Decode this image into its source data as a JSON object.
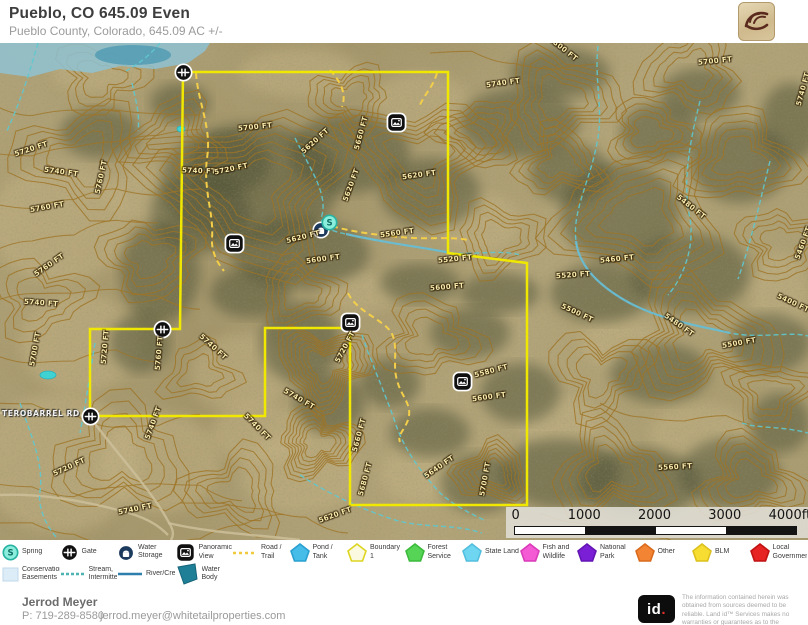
{
  "header": {
    "title": "Pueblo, CO 645.09 Even",
    "subtitle": "Pueblo County, Colorado, 645.09 AC +/-"
  },
  "footer": {
    "agent_name": "Jerrod Meyer",
    "phone": "P: 719-289-8580",
    "email": "jerrod.meyer@whitetailproperties.com",
    "brand_id": "id",
    "brand_dot": ".",
    "disclaimer": "The information contained herein was obtained from sources deemed to be reliable. Land id™ Services makes no warranties or guarantees as to the completeness or accuracy thereof."
  },
  "scale_bar": {
    "labels": [
      "0",
      "1000",
      "2000",
      "3000",
      "4000ft"
    ],
    "segment_colors": [
      "#ffffff",
      "#141414",
      "#ffffff",
      "#141414"
    ]
  },
  "legend": {
    "row1": [
      {
        "label": "Spring",
        "swatch": {
          "kind": "spring"
        }
      },
      {
        "label": "Gate",
        "swatch": {
          "kind": "gate"
        }
      },
      {
        "label": "Water Storage Tank",
        "swatch": {
          "kind": "tank"
        }
      },
      {
        "label": "Panoramic View",
        "swatch": {
          "kind": "pano"
        }
      },
      {
        "label": "Road / Trail",
        "swatch": {
          "kind": "line",
          "color": "#f0c93d",
          "dash": "3,3"
        }
      },
      {
        "label": "Pond / Tank",
        "swatch": {
          "kind": "poly",
          "fill": "#45bde8",
          "stroke": "#2a9fd0"
        }
      },
      {
        "label": "Boundary 1",
        "swatch": {
          "kind": "poly",
          "fill": "#fbf9df",
          "stroke": "#ddd520"
        }
      },
      {
        "label": "Forest Service",
        "swatch": {
          "kind": "poly",
          "fill": "#55d455",
          "stroke": "#3cba3c"
        }
      },
      {
        "label": "State Land",
        "swatch": {
          "kind": "poly",
          "fill": "#6fd6f2",
          "stroke": "#52bedd"
        }
      },
      {
        "label": "Fish and Wildlife",
        "swatch": {
          "kind": "poly",
          "fill": "#f55ad5",
          "stroke": "#d93bb8"
        }
      },
      {
        "label": "National Park",
        "swatch": {
          "kind": "poly",
          "fill": "#7a1fd6",
          "stroke": "#6315b3"
        }
      },
      {
        "label": "Other",
        "swatch": {
          "kind": "poly",
          "fill": "#f28433",
          "stroke": "#d96a1d"
        }
      },
      {
        "label": "BLM",
        "swatch": {
          "kind": "poly",
          "fill": "#f7dc32",
          "stroke": "#dcc01c"
        }
      },
      {
        "label": "Local Government",
        "swatch": {
          "kind": "poly",
          "fill": "#e62222",
          "stroke": "#c01212"
        }
      }
    ],
    "row2": [
      {
        "label": "Conservation Easements",
        "swatch": {
          "kind": "rect",
          "fill": "#dcedf8",
          "stroke": "#c2d8ea"
        }
      },
      {
        "label": "Stream, Intermittent",
        "swatch": {
          "kind": "line",
          "color": "#4fb3b3",
          "dash": "3,2"
        }
      },
      {
        "label": "River/Creek",
        "swatch": {
          "kind": "line",
          "color": "#2e7fae",
          "dash": ""
        }
      },
      {
        "label": "Water Body",
        "swatch": {
          "kind": "polybig",
          "fill": "#1f7f96",
          "stroke": "#16657a"
        }
      }
    ]
  },
  "map": {
    "road_label": {
      "text": "TEROBARREL RD",
      "x": 2,
      "y": 366
    },
    "colors": {
      "contour": "#9d7426",
      "boundary": "#f0e800",
      "trail": "#f2ce4a",
      "stream": "#5fc8cf",
      "river": "#68bcd4",
      "dirt_road": "#cdbf9a",
      "water_body": "#8fc2d2",
      "pond": "#3fd2d2"
    },
    "boundary_points": "183,29 448,29 448,210 527,220 527,462 350,462 350,285 265,285 265,373 90,373 90,286 180,286",
    "water_body_points": "0,0 210,0 205,8 188,20 155,26 120,23 92,30 60,26 30,34 0,30",
    "water_dark_patch": {
      "cx": 133,
      "cy": 12,
      "rx": 38,
      "ry": 10
    },
    "ponds": [
      {
        "cx": 181,
        "cy": 86,
        "rx": 4,
        "ry": 3
      },
      {
        "cx": 48,
        "cy": 332,
        "rx": 8,
        "ry": 4
      }
    ],
    "trails": [
      "M196,30 C198,60 212,85 207,115 C203,148 214,170 212,195 C211,210 219,222 224,228",
      "M330,27 C340,38 347,50 342,64",
      "M437,30 C433,44 424,52 420,62",
      "M332,183 C352,189 378,192 400,194 C428,197 448,193 468,197",
      "M348,250 C356,268 382,276 391,289 C399,302 392,322 397,337 C401,354 413,361 408,377 C404,388 397,392 400,399"
    ],
    "streams": [
      "M38,0 C30,28 22,55 6,90",
      "M160,0 C150,12 140,20 126,28",
      "M132,40 C136,58 140,72 138,88",
      "M295,95 C308,122 328,150 322,172 C319,183 330,188 346,191 C380,199 420,204 446,209 C470,213 500,206 520,212",
      "M598,3 C594,38 604,68 597,100 C590,138 572,168 576,198 C579,224 600,243 626,258 C660,277 700,283 730,290 C762,296 790,288 808,293",
      "M700,58 C690,98 682,138 690,176 C695,206 682,236 668,252",
      "M770,118 C760,158 752,196 738,236",
      "M362,292 C372,322 386,352 396,382 C406,410 422,430 440,450 C456,464 470,470 486,478",
      "M300,432 C330,452 362,466 392,476 C422,486 452,480 482,490",
      "M20,360 C30,390 44,420 40,448 C37,468 50,488 58,496",
      "M95,300 C90,330 86,360 80,390",
      "M742,380 C762,386 782,383 808,390"
    ],
    "rivers": [
      "M576,198 C579,224 600,243 626,258 C660,277 700,283 730,290",
      "M346,191 C380,199 420,204 446,209"
    ],
    "dirt_roads": [
      "M0,370 L88,372",
      "M90,374 C118,412 152,448 168,478 C176,490 172,495 171,497",
      "M0,452 C40,450 84,458 122,468 C152,476 162,486 168,492",
      "M168,480 C210,490 260,492 300,497"
    ],
    "icons": [
      {
        "type": "gate",
        "x": 183,
        "y": 29
      },
      {
        "type": "gate",
        "x": 162,
        "y": 286
      },
      {
        "type": "gate",
        "x": 90,
        "y": 373
      },
      {
        "type": "pano",
        "x": 396,
        "y": 79
      },
      {
        "type": "pano",
        "x": 234,
        "y": 200
      },
      {
        "type": "pano",
        "x": 350,
        "y": 279
      },
      {
        "type": "pano",
        "x": 462,
        "y": 338
      },
      {
        "type": "tank",
        "x": 321,
        "y": 187
      },
      {
        "type": "spring",
        "x": 329,
        "y": 179
      }
    ],
    "contour_labels": [
      {
        "t": "5720 FT",
        "x": 14,
        "y": 102,
        "r": -18
      },
      {
        "t": "5740 FT",
        "x": 44,
        "y": 125,
        "r": 8
      },
      {
        "t": "5760 FT",
        "x": 84,
        "y": 130,
        "r": -78
      },
      {
        "t": "5760 FT",
        "x": 30,
        "y": 160,
        "r": -10
      },
      {
        "t": "5760 FT",
        "x": 32,
        "y": 218,
        "r": -35
      },
      {
        "t": "5740 FT",
        "x": 24,
        "y": 256,
        "r": 4
      },
      {
        "t": "5700 FT",
        "x": 18,
        "y": 302,
        "r": -80
      },
      {
        "t": "5720 FT",
        "x": 88,
        "y": 300,
        "r": -85
      },
      {
        "t": "5760 FT",
        "x": 142,
        "y": 306,
        "r": -85
      },
      {
        "t": "5740 FT",
        "x": 196,
        "y": 300,
        "r": 42
      },
      {
        "t": "5740 FT",
        "x": 136,
        "y": 376,
        "r": -70
      },
      {
        "t": "5740 FT",
        "x": 240,
        "y": 380,
        "r": 45
      },
      {
        "t": "5740 FT",
        "x": 282,
        "y": 352,
        "r": 30
      },
      {
        "t": "5720 FT",
        "x": 52,
        "y": 420,
        "r": -25
      },
      {
        "t": "5740 FT",
        "x": 118,
        "y": 462,
        "r": -12
      },
      {
        "t": "5740 FT",
        "x": 182,
        "y": 124,
        "r": 2
      },
      {
        "t": "5720 FT",
        "x": 214,
        "y": 122,
        "r": -12
      },
      {
        "t": "5700 FT",
        "x": 238,
        "y": 80,
        "r": -6
      },
      {
        "t": "5620 FT",
        "x": 298,
        "y": 94,
        "r": -42
      },
      {
        "t": "5660 FT",
        "x": 344,
        "y": 86,
        "r": -75
      },
      {
        "t": "5620 FT",
        "x": 334,
        "y": 138,
        "r": -70
      },
      {
        "t": "5620 FT",
        "x": 402,
        "y": 128,
        "r": -8
      },
      {
        "t": "5560 FT",
        "x": 380,
        "y": 186,
        "r": -8
      },
      {
        "t": "5620 FT",
        "x": 286,
        "y": 190,
        "r": -14
      },
      {
        "t": "5600 FT",
        "x": 306,
        "y": 212,
        "r": -8
      },
      {
        "t": "5600 FT",
        "x": 430,
        "y": 240,
        "r": -5
      },
      {
        "t": "5520 FT",
        "x": 438,
        "y": 212,
        "r": -6
      },
      {
        "t": "5740 FT",
        "x": 486,
        "y": 36,
        "r": -8
      },
      {
        "t": "5800 FT",
        "x": 546,
        "y": 2,
        "r": 38
      },
      {
        "t": "5700 FT",
        "x": 698,
        "y": 14,
        "r": -6
      },
      {
        "t": "5740 FT",
        "x": 786,
        "y": 42,
        "r": -75
      },
      {
        "t": "5480 FT",
        "x": 674,
        "y": 160,
        "r": 38
      },
      {
        "t": "5460 FT",
        "x": 600,
        "y": 212,
        "r": -6
      },
      {
        "t": "5520 FT",
        "x": 556,
        "y": 228,
        "r": -4
      },
      {
        "t": "5500 FT",
        "x": 560,
        "y": 266,
        "r": 25
      },
      {
        "t": "5480 FT",
        "x": 662,
        "y": 278,
        "r": 35
      },
      {
        "t": "5400 FT",
        "x": 776,
        "y": 256,
        "r": 25
      },
      {
        "t": "5500 FT",
        "x": 722,
        "y": 296,
        "r": -10
      },
      {
        "t": "5460 FT",
        "x": 786,
        "y": 196,
        "r": -70
      },
      {
        "t": "5720 FT",
        "x": 328,
        "y": 300,
        "r": -62
      },
      {
        "t": "5580 FT",
        "x": 474,
        "y": 324,
        "r": -15
      },
      {
        "t": "5600 FT",
        "x": 472,
        "y": 350,
        "r": -8
      },
      {
        "t": "5640 FT",
        "x": 422,
        "y": 420,
        "r": -35
      },
      {
        "t": "5700 FT",
        "x": 468,
        "y": 432,
        "r": -80
      },
      {
        "t": "5680 FT",
        "x": 348,
        "y": 432,
        "r": -75
      },
      {
        "t": "5660 FT",
        "x": 342,
        "y": 388,
        "r": -75
      },
      {
        "t": "5560 FT",
        "x": 658,
        "y": 420,
        "r": -3
      },
      {
        "t": "5620 FT",
        "x": 318,
        "y": 468,
        "r": -20
      }
    ],
    "terrain": {
      "hills": [
        [
          250,
          145,
          95,
          7
        ],
        [
          420,
          115,
          70,
          6
        ],
        [
          560,
          55,
          55,
          5
        ],
        [
          150,
          215,
          48,
          4
        ],
        [
          640,
          175,
          80,
          6
        ],
        [
          740,
          115,
          55,
          5
        ],
        [
          700,
          295,
          68,
          6
        ],
        [
          325,
          322,
          46,
          8
        ],
        [
          318,
          400,
          40,
          7
        ],
        [
          492,
          430,
          36,
          6
        ],
        [
          610,
          428,
          55,
          5
        ],
        [
          750,
          438,
          50,
          5
        ],
        [
          430,
          295,
          48,
          4
        ],
        [
          175,
          95,
          45,
          4
        ],
        [
          80,
          115,
          60,
          4
        ],
        [
          120,
          415,
          65,
          4
        ],
        [
          40,
          255,
          45,
          3
        ],
        [
          600,
          330,
          48,
          4
        ],
        [
          782,
          200,
          42,
          4
        ],
        [
          500,
          195,
          42,
          4
        ],
        [
          690,
          28,
          48,
          4
        ],
        [
          350,
          55,
          38,
          4
        ],
        [
          100,
          35,
          40,
          3
        ],
        [
          235,
          448,
          48,
          4
        ],
        [
          560,
          120,
          40,
          4
        ],
        [
          300,
          250,
          40,
          4
        ],
        [
          480,
          90,
          40,
          4
        ],
        [
          200,
          330,
          35,
          3
        ],
        [
          650,
          90,
          40,
          4
        ],
        [
          770,
          350,
          40,
          4
        ]
      ],
      "open_lines": [
        {
          "x": -10,
          "y": 60,
          "n": 5
        },
        {
          "x": -10,
          "y": 110,
          "n": 5
        },
        {
          "x": -10,
          "y": 160,
          "n": 5
        },
        {
          "x": -10,
          "y": 210,
          "n": 4
        },
        {
          "x": -10,
          "y": 260,
          "n": 5
        },
        {
          "x": -10,
          "y": 310,
          "n": 4
        },
        {
          "x": -10,
          "y": 360,
          "n": 5
        },
        {
          "x": -10,
          "y": 440,
          "n": 6
        },
        {
          "x": -10,
          "y": 480,
          "n": 7
        },
        {
          "x": 180,
          "y": 460,
          "n": 4
        },
        {
          "x": 540,
          "y": 470,
          "n": 6
        },
        {
          "x": 430,
          "y": 10,
          "n": 4
        },
        {
          "x": 600,
          "y": 360,
          "n": 4
        }
      ],
      "dark_patches": [
        [
          250,
          140,
          90,
          60
        ],
        [
          350,
          110,
          60,
          40
        ],
        [
          300,
          210,
          70,
          35
        ],
        [
          200,
          170,
          50,
          40
        ],
        [
          430,
          150,
          50,
          35
        ],
        [
          520,
          80,
          60,
          35
        ],
        [
          560,
          30,
          50,
          25
        ],
        [
          620,
          170,
          60,
          50
        ],
        [
          690,
          230,
          60,
          40
        ],
        [
          600,
          250,
          50,
          30
        ],
        [
          740,
          120,
          50,
          40
        ],
        [
          770,
          300,
          40,
          30
        ],
        [
          660,
          330,
          50,
          30
        ],
        [
          470,
          290,
          40,
          25
        ],
        [
          520,
          350,
          40,
          30
        ],
        [
          560,
          430,
          60,
          35
        ],
        [
          640,
          440,
          60,
          35
        ],
        [
          730,
          430,
          50,
          35
        ],
        [
          480,
          440,
          40,
          30
        ],
        [
          300,
          300,
          40,
          40
        ],
        [
          330,
          360,
          35,
          30
        ],
        [
          230,
          120,
          40,
          30
        ],
        [
          160,
          230,
          40,
          50
        ],
        [
          140,
          300,
          30,
          30
        ],
        [
          430,
          390,
          40,
          25
        ],
        [
          390,
          340,
          30,
          25
        ],
        [
          700,
          50,
          40,
          25
        ],
        [
          790,
          80,
          30,
          40
        ],
        [
          780,
          380,
          30,
          30
        ],
        [
          250,
          250,
          40,
          25
        ],
        [
          180,
          60,
          30,
          20
        ],
        [
          100,
          90,
          40,
          25
        ],
        [
          420,
          240,
          40,
          20
        ],
        [
          500,
          250,
          40,
          20
        ],
        [
          570,
          130,
          40,
          30
        ],
        [
          660,
          90,
          40,
          30
        ]
      ],
      "light_patches": [
        [
          60,
          180,
          70,
          60
        ],
        [
          80,
          300,
          60,
          50
        ],
        [
          60,
          420,
          80,
          70
        ],
        [
          160,
          420,
          60,
          50
        ],
        [
          300,
          430,
          60,
          40
        ],
        [
          240,
          330,
          50,
          40
        ],
        [
          420,
          60,
          50,
          30
        ],
        [
          480,
          180,
          40,
          30
        ],
        [
          300,
          30,
          60,
          25
        ],
        [
          150,
          150,
          40,
          30
        ],
        [
          700,
          390,
          50,
          30
        ],
        [
          420,
          430,
          40,
          30
        ],
        [
          560,
          380,
          40,
          25
        ],
        [
          780,
          250,
          30,
          40
        ],
        [
          620,
          300,
          40,
          25
        ],
        [
          100,
          30,
          50,
          20
        ],
        [
          360,
          250,
          40,
          20
        ],
        [
          260,
          390,
          50,
          30
        ]
      ]
    }
  }
}
